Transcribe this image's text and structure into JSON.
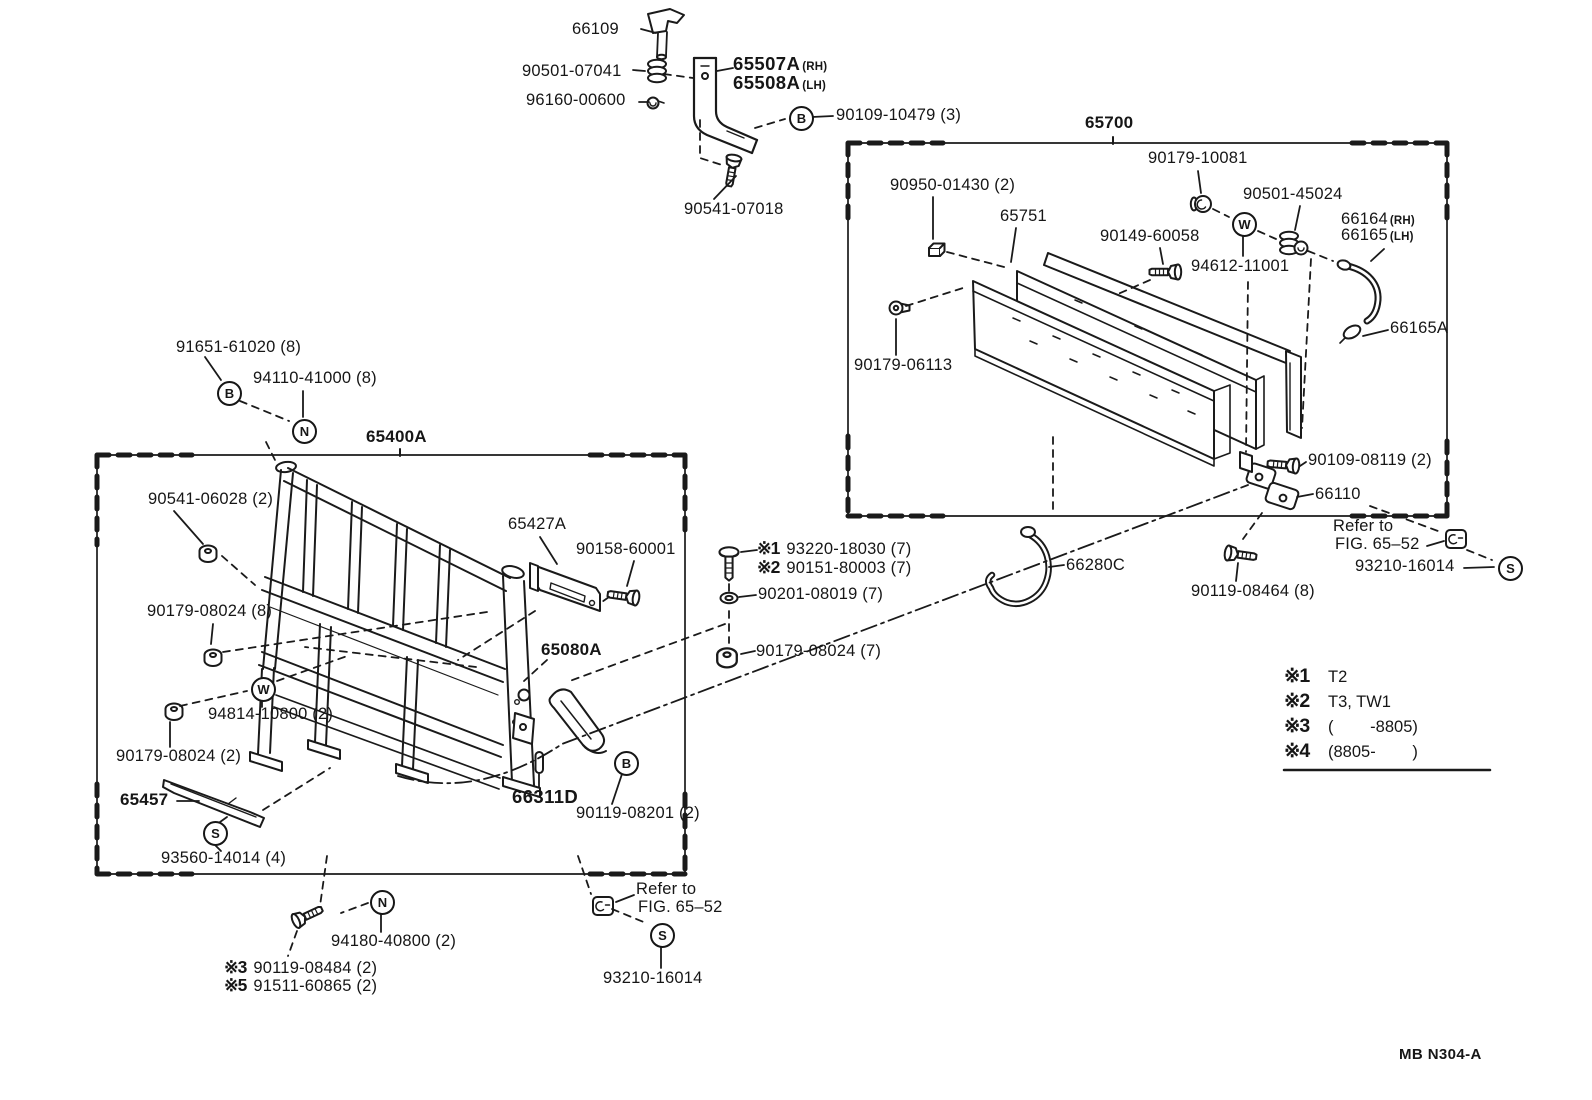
{
  "doc_code": "MB N304-A",
  "circled": {
    "b": "B",
    "n": "N",
    "w": "W",
    "s": "S"
  },
  "top_group": {
    "pin": "66109",
    "cushion": "90501-07041",
    "grommet": "96160-00600",
    "support_rh": "65507A",
    "support_rh_side": "(RH)",
    "support_lh": "65508A",
    "support_lh_side": "(LH)",
    "bolt": "90109-10479 (3)",
    "screw": "90541-07018"
  },
  "right_box": {
    "title": "65700",
    "grommet": "90179-10081",
    "spacer": "90950-01430 (2)",
    "board": "65751",
    "bolt_small": "90149-60058",
    "cushion": "90501-45024",
    "washer": "94612-11001",
    "rod_rh": "66164",
    "rod_rh_side": "(RH)",
    "rod_lh": "66165",
    "rod_lh_side": "(LH)",
    "rod_clip": "66165A",
    "clip": "90179-06113",
    "hinge_bolt": "90109-08119 (2)",
    "hinge": "66110",
    "refer_1": "Refer to",
    "refer_2": "FIG. 65–52",
    "screw_washer": "93210-16014",
    "bolt_8": "90119-08464 (8)",
    "hook": "66280C"
  },
  "left_box": {
    "title": "65400A",
    "nut_b": "91651-61020 (8)",
    "washer_n": "94110-41000 (8)",
    "grommet": "90541-06028 (2)",
    "plate": "65427A",
    "plate_bolt": "90158-60001",
    "latch": "65080A",
    "nut_8": "90179-08024 (8)",
    "washer_w": "94814-10800 (2)",
    "nut_2": "90179-08024 (2)",
    "protector": "65457",
    "protector_screw": "93560-14014 (4)",
    "pin": "66311D",
    "latch_bolt": "90119-08201 (2)",
    "stack": {
      "rows": [
        {
          "sym": "※1",
          "num": "93220-18030 (7)"
        },
        {
          "sym": "※2",
          "num": "90151-80003 (7)"
        }
      ],
      "washer": "90201-08019 (7)",
      "nut": "90179-08024 (7)"
    },
    "bottom_bolt": "94180-40800 (2)",
    "bottom_rows": [
      {
        "sym": "※3",
        "num": "90119-08484 (2)"
      },
      {
        "sym": "※5",
        "num": "91511-60865 (2)"
      }
    ],
    "refer_1": "Refer to",
    "refer_2": "FIG. 65–52",
    "screw_washer": "93210-16014"
  },
  "legend": {
    "rows": [
      {
        "sym": "※1",
        "text": "T2"
      },
      {
        "sym": "※2",
        "text": "T3, TW1"
      },
      {
        "sym": "※3",
        "text": "(        -8805)"
      },
      {
        "sym": "※4",
        "text": "(8805-        )"
      }
    ]
  }
}
